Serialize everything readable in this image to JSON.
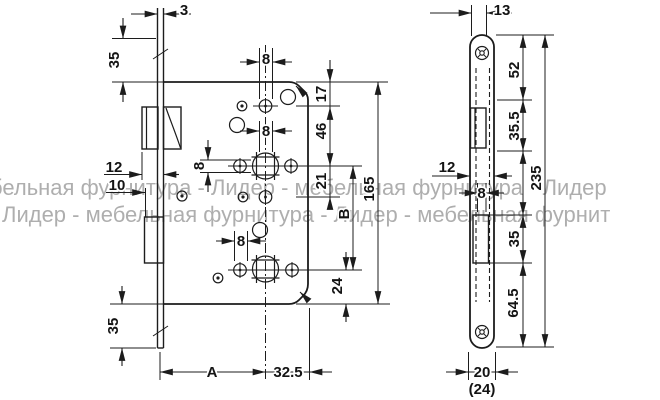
{
  "colors": {
    "line": "#1c1c1c",
    "watermark": "#9b9b9b"
  },
  "watermark": {
    "line1": "бельная фурнитура - Лидер - мебельная фурнитура - Лидер",
    "line2": "Лидер - мебельная фурнитура - Лидер - мебельная фурнит"
  },
  "side_view": {
    "plate_thickness": "3",
    "top_margin": "35",
    "latch_projection": "12",
    "bolt_projection": "10",
    "bottom_margin": "35",
    "hole_top": "8",
    "hole_mid": "8",
    "square_size": "8",
    "hole_low": "8",
    "edge_to_holes": "17",
    "hole_to_spindle": "46",
    "spindle_to_row": "21",
    "case_height": "165",
    "spindle_to_bolt": "B",
    "bolt_to_edge": "24",
    "backset": "A",
    "center_to_edge": "32.5"
  },
  "front_view": {
    "top_offset": "13",
    "top_to_latch": "52",
    "latch_cutout": "35.5",
    "case_width": "12",
    "slot_width": "8",
    "bolt_cutout": "35",
    "bolt_to_end": "64.5",
    "plate_length": "235",
    "plate_width": "20",
    "plate_width_alt": "(24)"
  }
}
